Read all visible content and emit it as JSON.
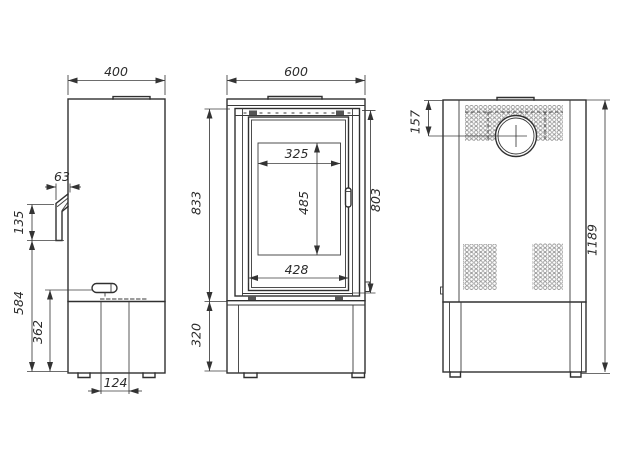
{
  "meta": {
    "background": "#ffffff",
    "line_color": "#303030",
    "dim_text_color": "#2c2c2c",
    "mesh_color": "#8f8f8f"
  },
  "views": {
    "side": {
      "label": "side-view",
      "dims": {
        "depth": "400",
        "door_offset": "63",
        "door_front_height": "135",
        "lower_body_height": "584",
        "handle_height": "362",
        "drawer_width": "124"
      }
    },
    "front": {
      "label": "front-view",
      "dims": {
        "width": "600",
        "upper_body_height": "833",
        "door_height": "803",
        "glass_width": "325",
        "glass_height": "485",
        "door_opening_width": "428",
        "base_height": "320"
      }
    },
    "rear": {
      "label": "rear-view",
      "dims": {
        "flue_center_from_top": "157",
        "total_height": "1189"
      }
    }
  }
}
